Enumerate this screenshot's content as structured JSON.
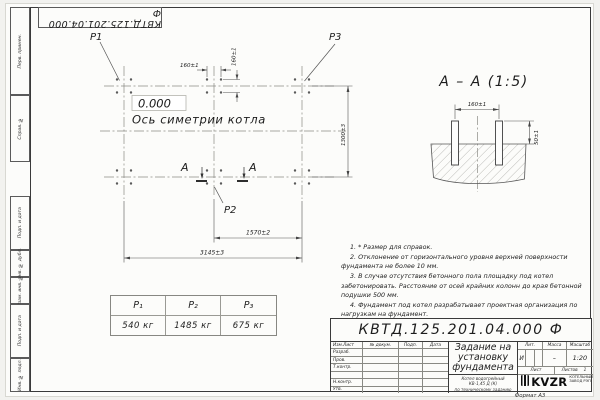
{
  "frame": {
    "stamp_top": "КВТД.125.201.04.000  Ф",
    "format_note": "Формат А3",
    "sidebar": {
      "perv": "Перв. примен.",
      "sprav": "Справ. №",
      "podp1": "Подп. и дата",
      "inv_dubl": "Инв. № дубл.",
      "vzam": "Взам. инв. №",
      "podp2": "Подп. и дата",
      "inv_podl": "Инв. № подл."
    }
  },
  "plan": {
    "p1": "P1",
    "p2": "P2",
    "p3": "P3",
    "elevation": "0.000",
    "axis_label": "Ось симетрии котла",
    "section_letter": "А",
    "dim_160h": "160±1",
    "dim_160v": "160±1",
    "dim_1570": "1570±2",
    "dim_3145": "3145±3",
    "dim_1300": "1300±3"
  },
  "section": {
    "title": "А – А (1:5)",
    "dim_160": "160±1",
    "dim_50": "50±1"
  },
  "loads": {
    "headers": [
      "Р₁",
      "Р₂",
      "Р₃"
    ],
    "values": [
      "540 кг",
      "1485 кг",
      "675 кг"
    ]
  },
  "notes": {
    "n1": "1. * Размер для справок.",
    "n2": "2. Отклонение от горизонтального уровня верхней поверхности фундамента не более 10 мм.",
    "n3": "3. В случае отсутствия бетонного пола площадку под котел забетонировать. Расстояние от осей крайних колонн до края бетонной подушки 500 мм.",
    "n4": "4. Фундамент под котел разрабатывает проектная организация по нагрузкам на фундамент."
  },
  "titleblock": {
    "doc_number": "КВТД.125.201.04.000  Ф",
    "title_line1": "Задание на",
    "title_line2": "установку",
    "title_line3": "фундамента",
    "subtitle_line1": "Котел водогрейный",
    "subtitle_line2": "КВ-1,45 Д (К)",
    "subtitle_line3": "по техническому заданию",
    "col_izm": "Изм.Лист",
    "col_dokum": "№ докум.",
    "col_podp": "Подп.",
    "col_data": "Дата",
    "row_razrab": "Разраб.",
    "row_prov": "Пров.",
    "row_tkontr": "Т.контр.",
    "row_nkontr": "Н.контр.",
    "row_utv": "Утв.",
    "lit_label": "Лит.",
    "mass_label": "Масса",
    "scale_label": "Масштаб",
    "lit_value": "И",
    "mass_value": "–",
    "scale_value": "1:20",
    "sheet_label": "Лист",
    "sheets_label": "Листов",
    "sheets_value": "1",
    "logo_text": "KVZR",
    "logo_caption_line1": "КОТЕЛЬНЫЙ",
    "logo_caption_line2": "ЗАВОД РЭП"
  }
}
